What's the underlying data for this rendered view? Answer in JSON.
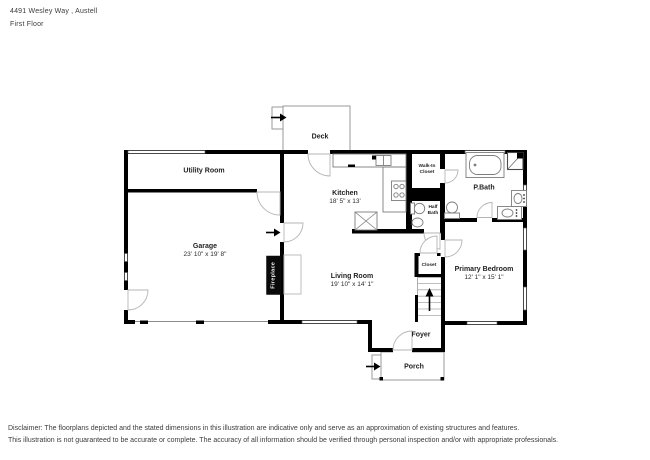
{
  "header": {
    "address": "4491 Wesley Way , Austell",
    "floor_label": "First Floor"
  },
  "rooms": {
    "deck": {
      "label": "Deck"
    },
    "utility_room": {
      "label": "Utility Room"
    },
    "garage": {
      "label": "Garage",
      "dims": "23' 10\" x 19' 8\""
    },
    "kitchen": {
      "label": "Kitchen",
      "dims": "18' 5\" x 13'"
    },
    "walk_in_closet": {
      "label": "Walk-In\nCloset"
    },
    "p_bath": {
      "label": "P.Bath"
    },
    "half_bath": {
      "label": "Half\nBath"
    },
    "living_room": {
      "label": "Living Room",
      "dims": "19' 10\" x 14' 1\""
    },
    "closet": {
      "label": "Closet"
    },
    "primary_bedroom": {
      "label": "Primary Bedroom",
      "dims": "12' 1\" x 15' 1\""
    },
    "foyer": {
      "label": "Foyer"
    },
    "porch": {
      "label": "Porch"
    },
    "fireplace": {
      "label": "Fireplace"
    }
  },
  "footer": {
    "line1": "Disclaimer: The floorplans depicted and the stated dimensions in this illustration are indicative only and serve as an approximation of existing structures and features.",
    "line2": "This illustration is not guaranteed to be accurate or complete. The accuracy of all information should be verified through personal inspection and/or with appropriate professionals."
  },
  "colors": {
    "wall": "#000000",
    "fixture_line": "#7d7d7d",
    "text": "#1f1f1f"
  }
}
